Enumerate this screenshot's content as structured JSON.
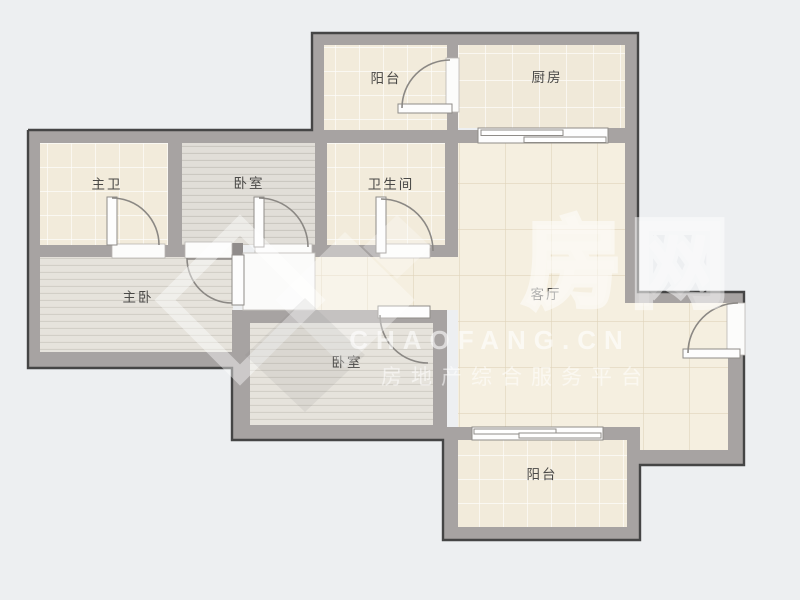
{
  "plan": {
    "rooms": [
      {
        "id": "balcony-top",
        "label": "阳台"
      },
      {
        "id": "kitchen",
        "label": "厨房"
      },
      {
        "id": "master-bathroom",
        "label": "主卫"
      },
      {
        "id": "bedroom-upper",
        "label": "卧室"
      },
      {
        "id": "bathroom",
        "label": "卫生间"
      },
      {
        "id": "living-room",
        "label": "客厅"
      },
      {
        "id": "master-bedroom",
        "label": "主卧"
      },
      {
        "id": "bedroom-lower",
        "label": "卧室"
      },
      {
        "id": "balcony-lower",
        "label": "阳台"
      }
    ],
    "colors": {
      "background": "#edeff1",
      "wall": "#a7a3a2",
      "wall_outline": "#454545",
      "tile_floor": "#f2ebdb",
      "kitchen_floor": "#f0e9d9",
      "living_floor": "#f5efe0",
      "wood_floor": "#e6e3dc",
      "wood_floor_gray": "#e1ded8",
      "door_white": "#fcfcfb",
      "label_text": "#4a4947"
    }
  },
  "watermark": {
    "brand_cjk": "房网",
    "domain": "CHAOFANG.CN",
    "tagline": "房地产综合服务平台"
  }
}
